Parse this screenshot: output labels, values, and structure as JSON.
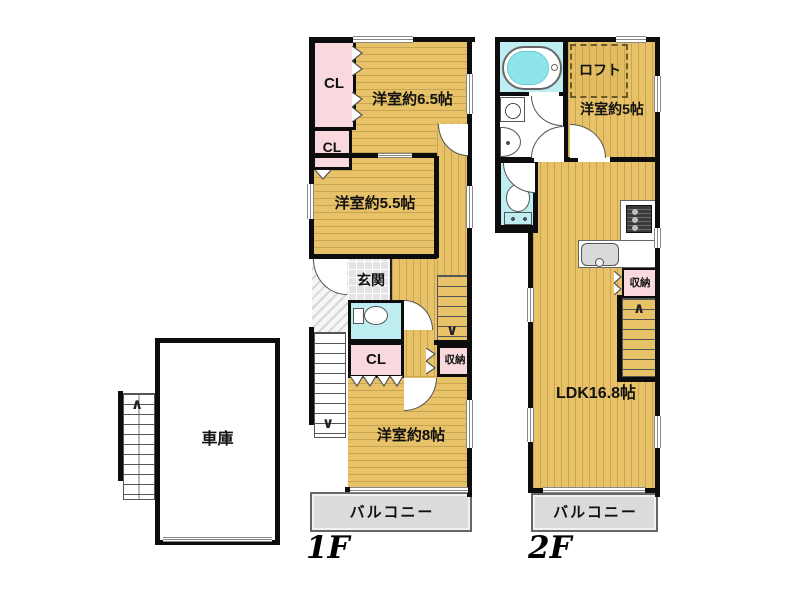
{
  "title": "間取り図",
  "colors": {
    "floor_tan": "#e7c268",
    "closet_pink": "#f9d9de",
    "water_cyan": "#bfeef2",
    "balcony_gray": "#dbdbdb",
    "wall_black": "#0d0d0d"
  },
  "icons": {
    "up_arrow": "∧",
    "down_arrow": "∨"
  },
  "floor1": {
    "label": "1F",
    "rooms": {
      "cl_upper": "CL",
      "western65": "洋室約6.5帖",
      "cl_mid": "CL",
      "western55": "洋室約5.5帖",
      "genkan": "玄関",
      "cl_lower": "CL",
      "storage": "収納",
      "western8": "洋室約8帖",
      "balcony": "バルコニー",
      "garage": "車庫"
    }
  },
  "floor2": {
    "label": "2F",
    "rooms": {
      "loft": "ロフト",
      "western5": "洋室約5帖",
      "storage": "収納",
      "ldk": "LDK16.8帖",
      "balcony": "バルコニー"
    }
  }
}
